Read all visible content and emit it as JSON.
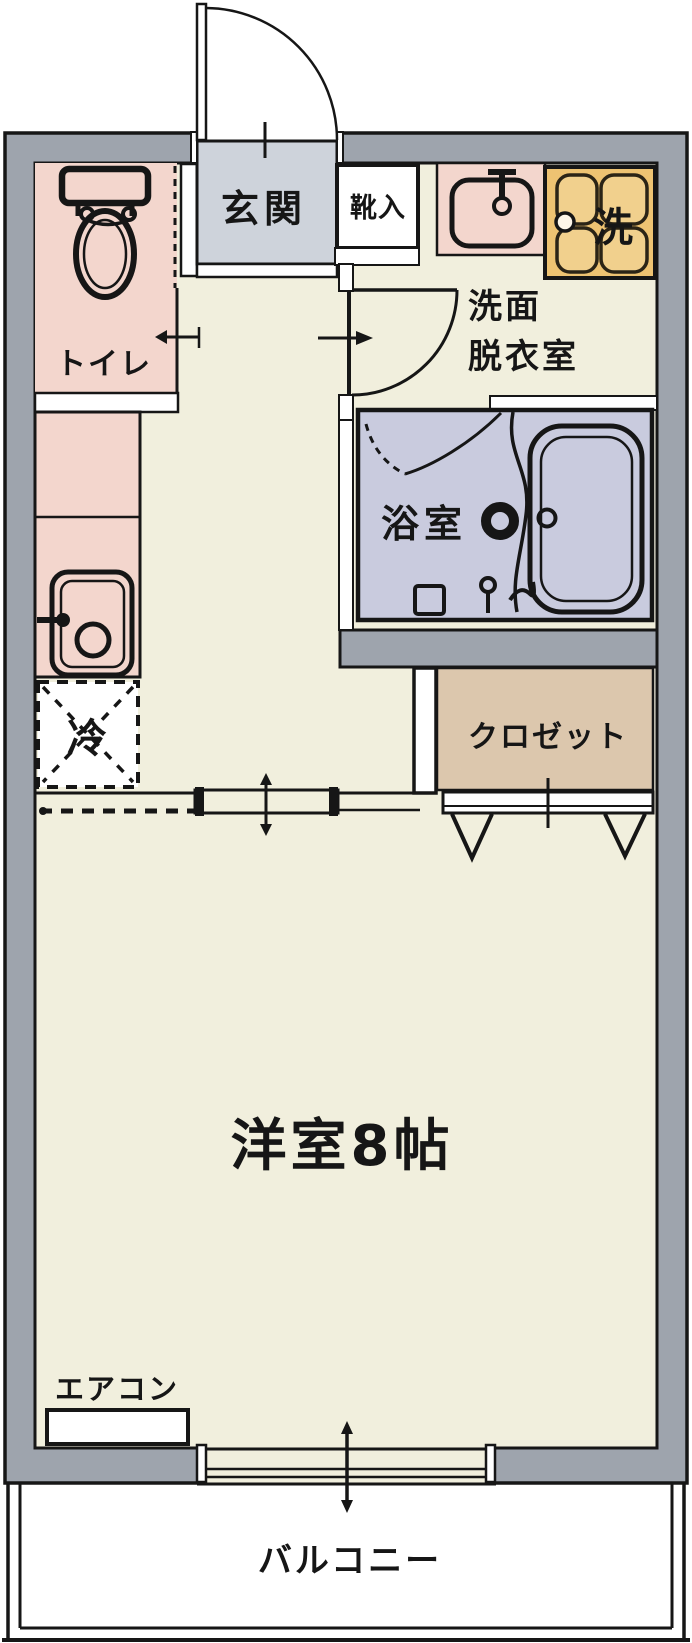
{
  "floor_plan": {
    "labels": {
      "genkan": "玄関",
      "shoe_cabinet": "靴入",
      "toilet": "トイレ",
      "washer": "洗",
      "washroom_line1": "洗面",
      "washroom_line2": "脱衣室",
      "bathroom": "浴室",
      "closet": "クロゼット",
      "refrigerator": "冷",
      "main_room": "洋室8帖",
      "aircon": "エアコン",
      "balcony": "バルコニー"
    },
    "colors": {
      "wall": "#9ea4ad",
      "outline": "#161616",
      "floor": "#f1efdd",
      "pink": "#f3d6cd",
      "entrance": "#ced3db",
      "bathroom": "#c9cbde",
      "closet": "#dcc7ad",
      "washer": "#eec372",
      "washer_inner": "#f1d08d",
      "white": "#ffffff"
    }
  }
}
